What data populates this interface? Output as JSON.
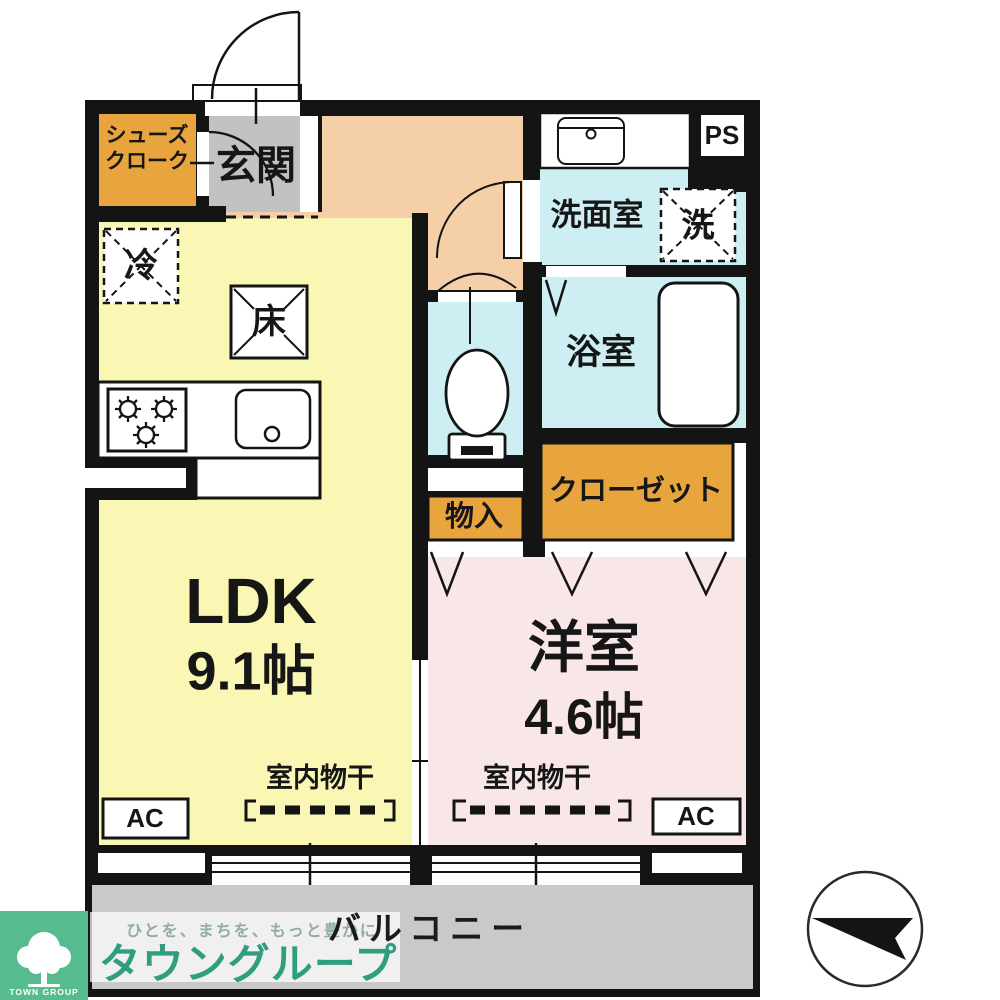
{
  "floorplan": {
    "rooms": {
      "shoes_closet": {
        "line1": "シューズ",
        "line2": "クローク"
      },
      "entrance": "玄関",
      "washroom": "洗面室",
      "washing_machine": "洗",
      "pipe_space": "PS",
      "refrigerator": "冷",
      "floor_storage": "床",
      "bathroom": "浴室",
      "closet": "クローゼット",
      "storage": "物入",
      "ldk": {
        "name": "LDK",
        "area": "9.1帖"
      },
      "western_room": {
        "name": "洋室",
        "area": "4.6帖"
      },
      "indoor_drying_ldk": "室内物干",
      "indoor_drying_western": "室内物干",
      "ac_ldk": "AC",
      "ac_western": "AC",
      "balcony": "バルコニー"
    },
    "branding": {
      "tagline": "ひとを、まちを、もっと豊かに",
      "company": "タウングループ",
      "logo_text": "TOWN GROUP"
    },
    "colors": {
      "wall_black": "#141414",
      "ldk_yellow": "#faf7b4",
      "western_pink": "#f9e6e6",
      "hall_peach": "#f4cfa7",
      "wet_area_blue": "#cdeef2",
      "storage_orange": "#e8a53e",
      "entrance_gray": "#c2c2c2",
      "balcony_gray": "#c9c9c9",
      "logo_green": "#57bb90",
      "company_green": "#2f9e7f"
    }
  }
}
